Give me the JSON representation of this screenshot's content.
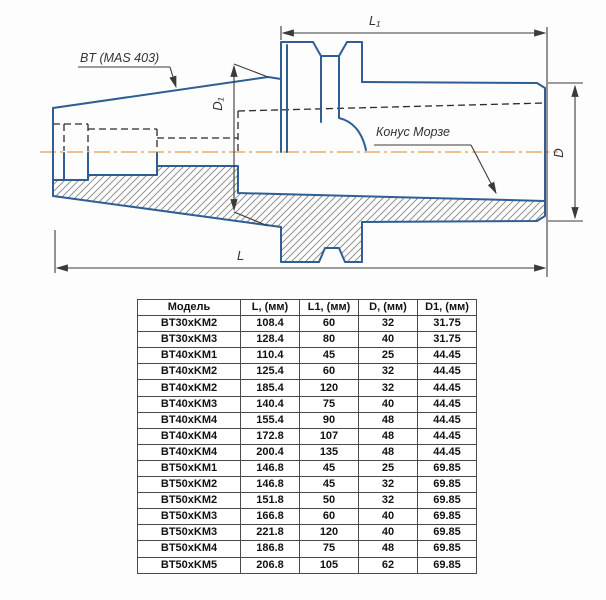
{
  "drawing": {
    "bt_label": "BT (MAS 403)",
    "morse_label": "Конус Морзе",
    "dims": {
      "l1": "L₁",
      "d1": "D₁",
      "d": "D",
      "l": "L"
    },
    "colors": {
      "outline": "#2e5e94",
      "centerline": "#ecc08f",
      "dimension": "#3a3a3a",
      "hatch": "#858585"
    }
  },
  "table": {
    "headers": [
      "Модель",
      "L, (мм)",
      "L1, (мм)",
      "D, (мм)",
      "D1, (мм)"
    ],
    "rows": [
      [
        "BT30xKM2",
        "108.4",
        "60",
        "32",
        "31.75"
      ],
      [
        "BT30xKM3",
        "128.4",
        "80",
        "40",
        "31.75"
      ],
      [
        "BT40xKM1",
        "110.4",
        "45",
        "25",
        "44.45"
      ],
      [
        "BT40xKM2",
        "125.4",
        "60",
        "32",
        "44.45"
      ],
      [
        "BT40xKM2",
        "185.4",
        "120",
        "32",
        "44.45"
      ],
      [
        "BT40xKM3",
        "140.4",
        "75",
        "40",
        "44.45"
      ],
      [
        "BT40xKM4",
        "155.4",
        "90",
        "48",
        "44.45"
      ],
      [
        "BT40xKM4",
        "172.8",
        "107",
        "48",
        "44.45"
      ],
      [
        "BT40xKM4",
        "200.4",
        "135",
        "48",
        "44.45"
      ],
      [
        "BT50xKM1",
        "146.8",
        "45",
        "25",
        "69.85"
      ],
      [
        "BT50xKM2",
        "146.8",
        "45",
        "32",
        "69.85"
      ],
      [
        "BT50xKM2",
        "151.8",
        "50",
        "32",
        "69.85"
      ],
      [
        "BT50xKM3",
        "166.8",
        "60",
        "40",
        "69.85"
      ],
      [
        "BT50xKM3",
        "221.8",
        "120",
        "40",
        "69.85"
      ],
      [
        "BT50xKM4",
        "186.8",
        "75",
        "48",
        "69.85"
      ],
      [
        "BT50xKM5",
        "206.8",
        "105",
        "62",
        "69.85"
      ]
    ]
  }
}
